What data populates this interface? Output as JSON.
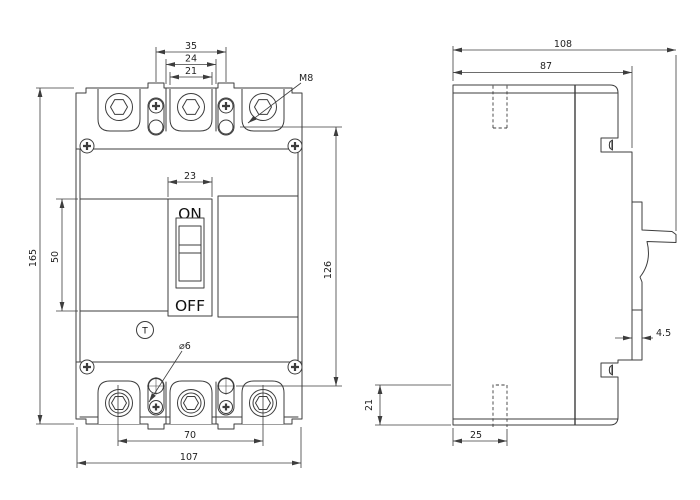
{
  "front_view": {
    "switch": {
      "on_label": "ON",
      "off_label": "OFF"
    },
    "test_button_label": "T",
    "dims": {
      "pitch_35": "35",
      "recess_24": "24",
      "pad_21": "21",
      "thread_m8": "M8",
      "handle_23": "23",
      "height_165": "165",
      "cover_50": "50",
      "mount_span_126": "126",
      "terminal_span_70": "70",
      "width_107": "107",
      "hole_dia_6": "⌀6"
    }
  },
  "side_view": {
    "dims": {
      "depth_108": "108",
      "body_depth_87": "87",
      "face_4_5": "4.5",
      "mount_21": "21",
      "slot_25": "25"
    }
  },
  "colors": {
    "line": "#3d3d3d",
    "text": "#1f1f1f",
    "background": "#ffffff"
  }
}
